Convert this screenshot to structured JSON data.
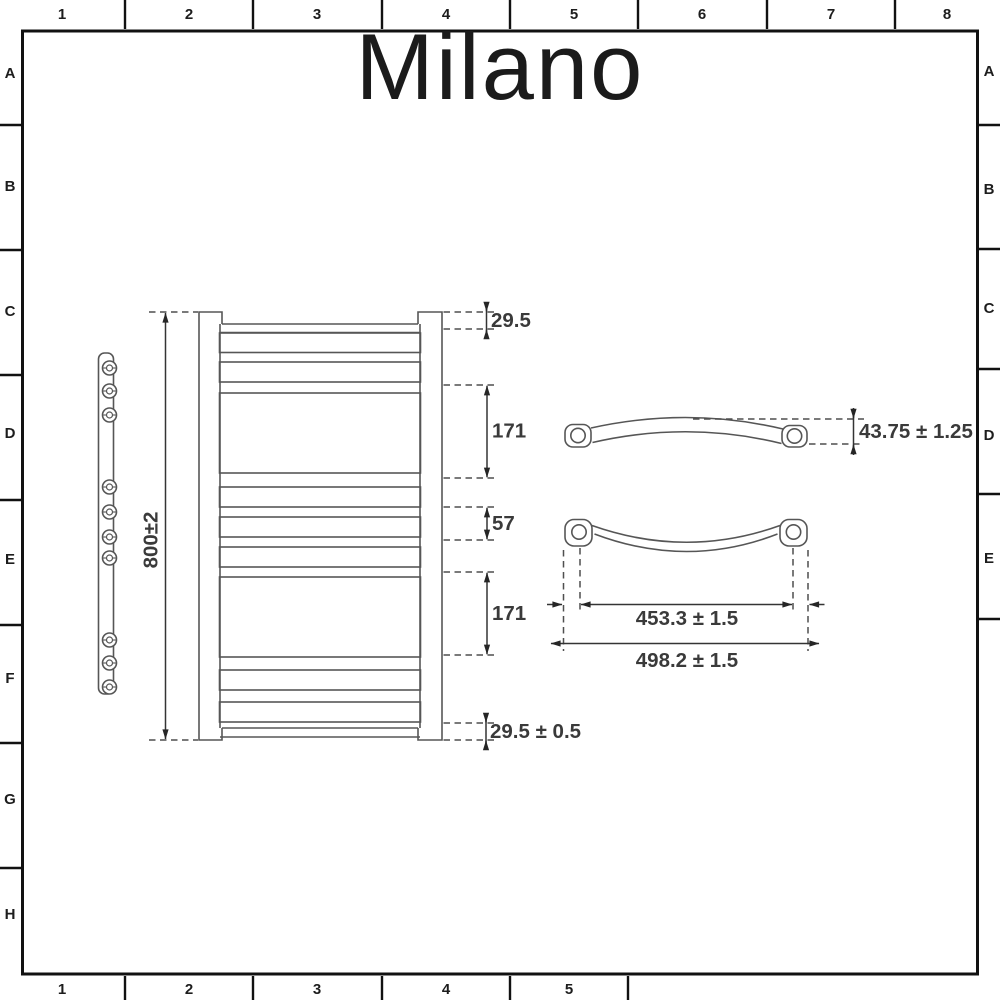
{
  "brand": {
    "name": "Milano"
  },
  "grid": {
    "top": [
      "1",
      "2",
      "3",
      "4",
      "5",
      "6",
      "7",
      "8"
    ],
    "bottom": [
      "1",
      "2",
      "3",
      "4",
      "5"
    ],
    "left": [
      "A",
      "B",
      "C",
      "D",
      "E",
      "F",
      "G",
      "H"
    ],
    "right": [
      "A",
      "B",
      "C",
      "D",
      "E"
    ]
  },
  "front_view": {
    "height_dim": "800±2",
    "top_offset_dim": "29.5",
    "upper_group_dim": "171",
    "centre_gap_dim": "57",
    "lower_group_dim": "171",
    "bottom_offset_dim": "29.5 ± 0.5"
  },
  "bar_top_view": {
    "depth_dim": "43.75 ± 1.25",
    "centres_dim": "453.3 ± 1.5",
    "overall_width_dim": "498.2 ± 1.5"
  },
  "colors": {
    "line": "#565656",
    "dimension_text": "#3a3a3a",
    "frame": "#111111",
    "background": "#ffffff"
  }
}
